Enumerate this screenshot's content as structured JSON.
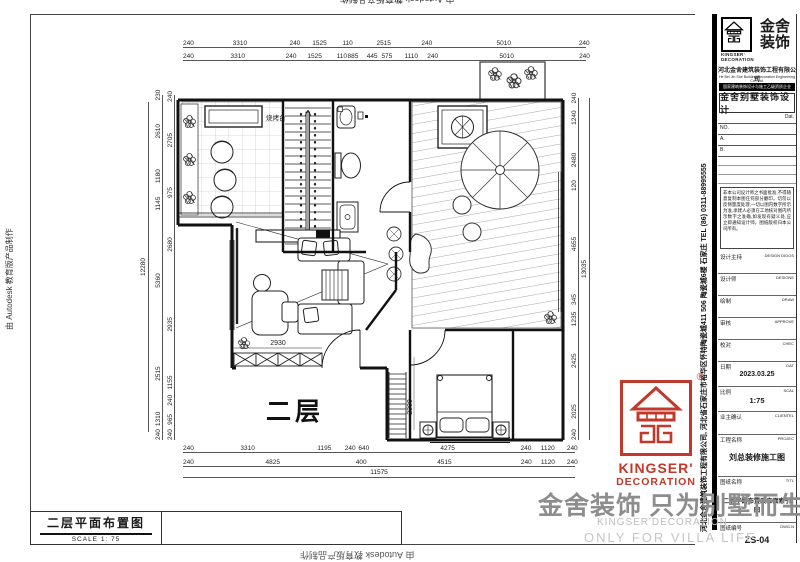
{
  "sheet": {
    "edge_note_left": "由 Autodesk 教育版产品制作",
    "edge_note_bottom": "由 Autodesk 教育版产品制作",
    "edge_note_top": "由 Autodesk 教育版产品制作"
  },
  "footer_box": {
    "title": "二层平面布置图",
    "scale": "SCALE 1: 75"
  },
  "watermark": {
    "cn": "金舍装饰 只为别墅而生。",
    "en1": "KINGSER'DECORATION",
    "en2": "ONLY FOR VILLA LIFE"
  },
  "stamp": {
    "reg": "®",
    "en1": "KINGSER'",
    "en2": "DECORATION",
    "color": "#c0392b"
  },
  "plan": {
    "floor_label": "二层",
    "bbq_label": "烧烤台",
    "dim_inner_h": "2930",
    "dim_inner_v": "2300"
  },
  "dims": {
    "top_row1": [
      "240",
      "3310",
      "240",
      "1525",
      "110",
      "2515",
      "240",
      "5010",
      "240"
    ],
    "top_row2": [
      "240",
      "3310",
      "240",
      "1525",
      "110",
      "885",
      "445",
      "575",
      "1110",
      "240",
      "5010",
      "240"
    ],
    "bottom_row1": [
      "240",
      "3310",
      "1195",
      "240",
      "640",
      "4275",
      "240",
      "1120",
      "240"
    ],
    "bottom_row2": [
      "240",
      "4825",
      "400",
      "4515",
      "240",
      "1120",
      "240"
    ],
    "bottom_total": "11575",
    "left_outer": [
      "230",
      "2610",
      "1180",
      "1145",
      "5360",
      "2515",
      "1310",
      "240"
    ],
    "left_inner": [
      "240",
      "2705",
      "975",
      "2680",
      "2935",
      "1155",
      "240",
      "965",
      "240"
    ],
    "left_total": "12280",
    "right_inner": [
      "240",
      "1240",
      "2480",
      "120",
      "4655",
      "345",
      "1235",
      "2425",
      "2025",
      "240"
    ],
    "right_total": "13035"
  },
  "titleblock": {
    "vertical_info": "河北金舍建筑装饰工程有限公司, 河北省石家庄市裕华区怀特陶瓷城411 506 陶瓷城6楼  石家庄  TEL  (86)  0311-88995555",
    "logo_cn": "金舍\n装饰",
    "logo_cn1": "金舍",
    "logo_cn2": "装饰",
    "logo_en1": "KINGSER'",
    "logo_en2": "DECORATION",
    "company": "河北金舍建筑装饰工程有限公司",
    "company_en": "He Bei Jin She Building Decoration Engineering Co., Ltd.",
    "black_bar": "国家建筑装饰设计与施工乙级资质企业",
    "dept_title": "金舍别墅装饰设计",
    "dat_label": "Dat.",
    "no_label": "NO.",
    "a_label": "A.",
    "b_label": "B.",
    "notes": "非本公司设计师之书面批准,不得随意复制本图任何部分翻印。切勿以反侧量度处理,一切以图内数字所示为准,承建人必须在工地核对图内所示数字之准确,如发现有疑义处,应立即通知设计师。图纸版权归本公司所有。",
    "fields": [
      {
        "label": "设计主持",
        "en": "DESIGN DIOOS",
        "value": ""
      },
      {
        "label": "设计师",
        "en": "DESIGNE",
        "value": ""
      },
      {
        "label": "绘制",
        "en": "DRAW",
        "value": ""
      },
      {
        "label": "审核",
        "en": "APPROVE",
        "value": ""
      },
      {
        "label": "校对",
        "en": "CHEC",
        "value": ""
      },
      {
        "label": "日期",
        "en": "DAT",
        "value": "2023.03.25"
      },
      {
        "label": "比例",
        "en": "SCAL",
        "value": "1:75"
      },
      {
        "label": "业主确认",
        "en": "CLIENTEL",
        "value": ""
      },
      {
        "label": "工程名称",
        "en": "PROJEC",
        "value": "刘总装修施工图"
      },
      {
        "label": "图纸名称",
        "en": "TITL",
        "value": "二层平面布置及立面索引图"
      },
      {
        "label": "图纸编号",
        "en": "DWG.N",
        "value": "ZS-04"
      }
    ]
  }
}
